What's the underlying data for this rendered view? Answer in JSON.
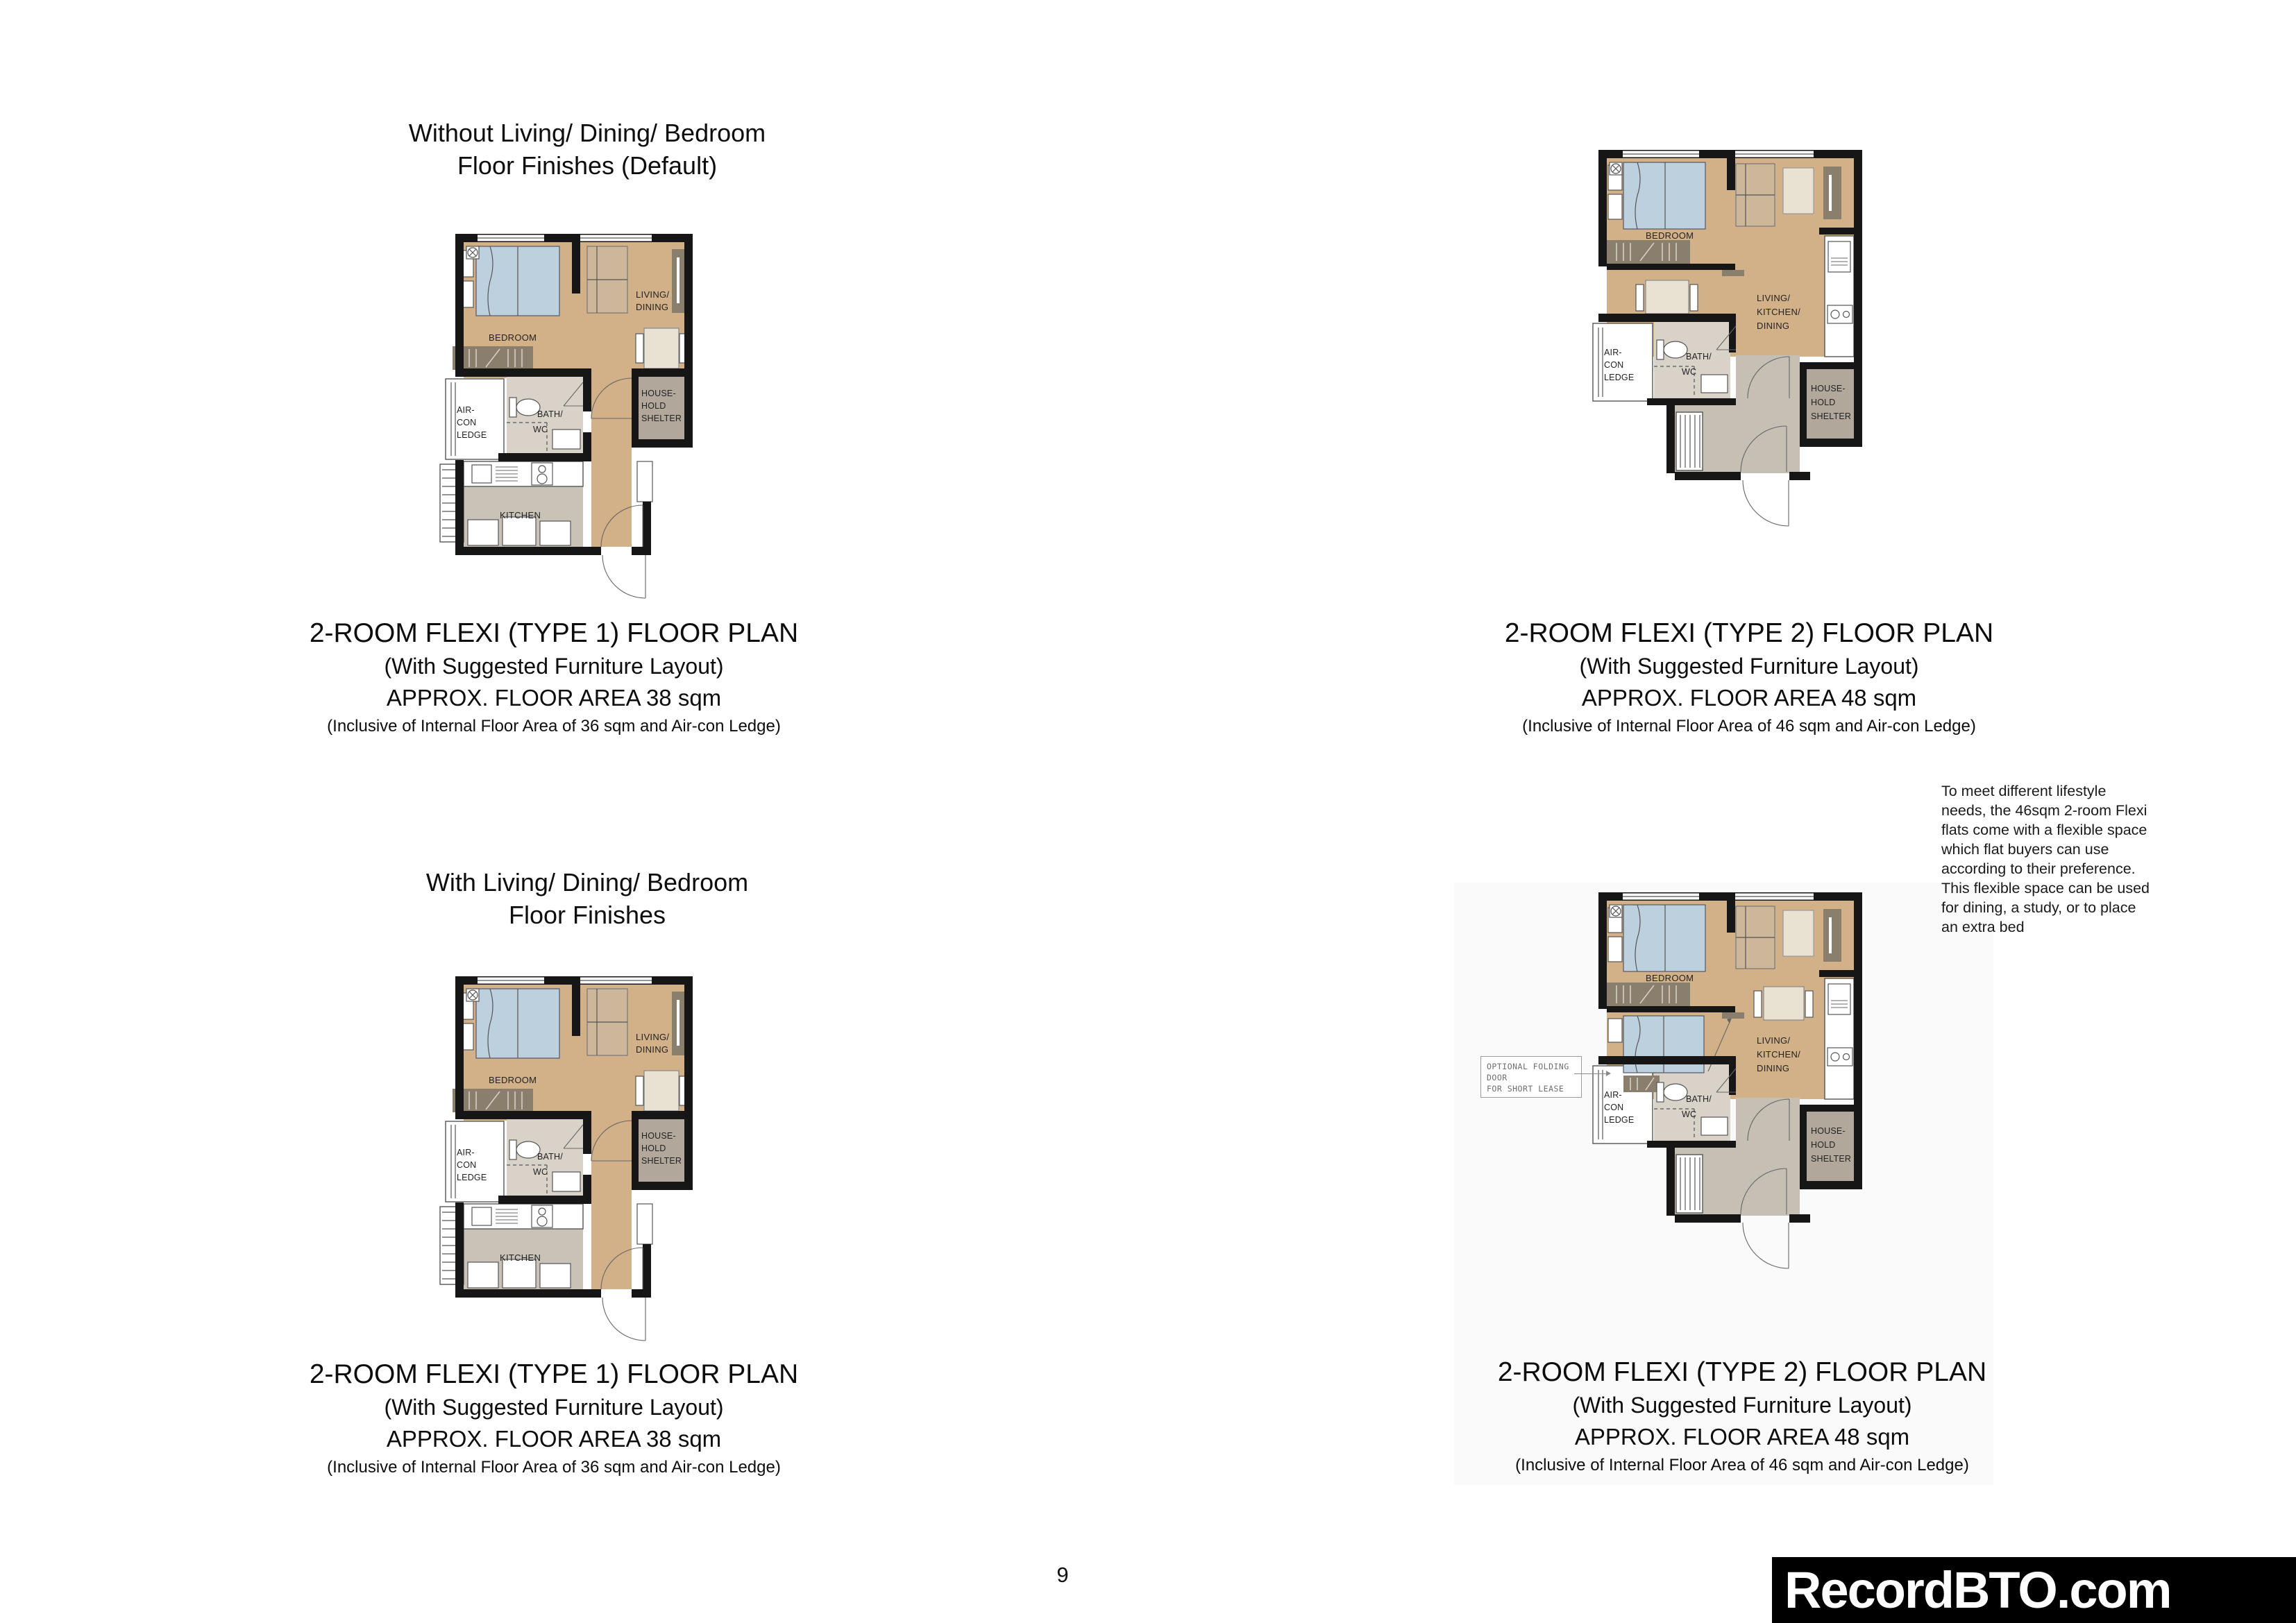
{
  "page": {
    "number": "9",
    "watermark": "RecordBTO.com"
  },
  "colors": {
    "floor_tan": "#d2b189",
    "bath_gray": "#d9d2c8",
    "kitchen_gray": "#c9c2b6",
    "foyer_gray": "#c6bfb3",
    "shelter_taupe": "#b1a89b",
    "bed_blue": "#bdd0dd",
    "furniture_tan": "#cdb79b",
    "cream": "#e9e1d2",
    "wardrobe_brown": "#8a7e6d",
    "wall_black": "#161616",
    "panel_gray": "#fafafa",
    "watermark_bg": "#000000",
    "watermark_fg": "#ffffff"
  },
  "titles": {
    "top_left": "Without Living/ Dining/ Bedroom\nFloor Finishes (Default)",
    "bottom_left": "With Living/ Dining/ Bedroom\nFloor Finishes"
  },
  "captions": {
    "type1": {
      "line1": "2-ROOM FLEXI (TYPE 1) FLOOR PLAN",
      "line2": "(With Suggested Furniture Layout)",
      "line3": "APPROX. FLOOR AREA 38 sqm",
      "line4": "(Inclusive of Internal Floor Area of 36 sqm and Air-con Ledge)"
    },
    "type2": {
      "line1": "2-ROOM FLEXI (TYPE 2) FLOOR PLAN",
      "line2": "(With Suggested Furniture Layout)",
      "line3": "APPROX. FLOOR AREA 48 sqm",
      "line4": "(Inclusive of Internal Floor Area of 46 sqm and Air-con Ledge)"
    }
  },
  "note": {
    "text": "To meet different lifestyle\nneeds, the 46sqm 2-room Flexi\nflats come with a flexible space\nwhich flat buyers can use\naccording to their preference.\nThis flexible space can be used\nfor dining, a study, or to place\nan extra bed"
  },
  "door_note": "OPTIONAL FOLDING DOOR\nFOR SHORT LEASE",
  "plan_labels": {
    "type1": {
      "bedroom": "BEDROOM",
      "living1": "LIVING/",
      "living2": "DINING",
      "aircon1": "AIR-",
      "aircon2": "CON",
      "aircon3": "LEDGE",
      "bath1": "BATH/",
      "bath2": "WC",
      "shelter1": "HOUSE-",
      "shelter2": "HOLD",
      "shelter3": "SHELTER",
      "kitchen": "KITCHEN"
    },
    "type2": {
      "bedroom": "BEDROOM",
      "lkd1": "LIVING/",
      "lkd2": "KITCHEN/",
      "lkd3": "DINING",
      "aircon1": "AIR-",
      "aircon2": "CON",
      "aircon3": "LEDGE",
      "bath1": "BATH/",
      "bath2": "WC",
      "shelter1": "HOUSE-",
      "shelter2": "HOLD",
      "shelter3": "SHELTER"
    }
  }
}
